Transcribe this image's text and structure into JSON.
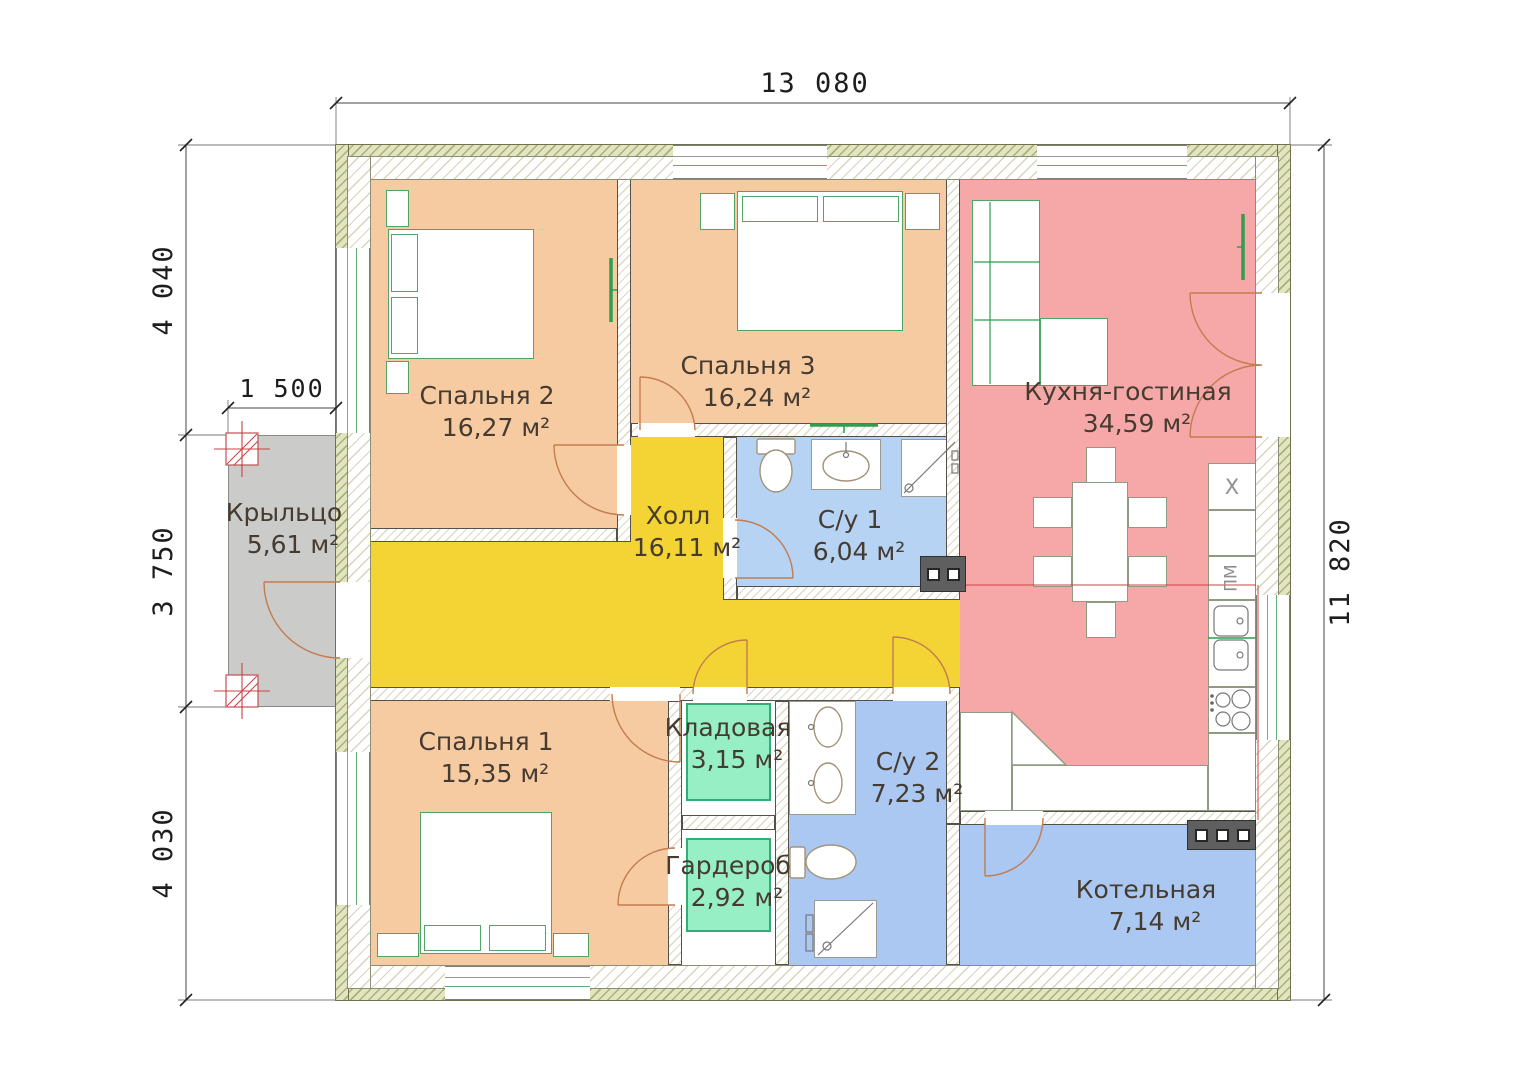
{
  "dimensions": {
    "top_width": "13 080",
    "left_upper": "4 040",
    "porch_width": "1 500",
    "left_middle": "3 750",
    "left_lower": "4 030",
    "right_height": "11 820"
  },
  "rooms": {
    "bedroom2": {
      "name": "Спальня 2",
      "area": "16,27 м²",
      "color": "#f7cba2"
    },
    "bedroom3": {
      "name": "Спальня 3",
      "area": "16,24 м²",
      "color": "#f7cba2"
    },
    "kitchen_living": {
      "name": "Кухня-гостиная",
      "area": "34,59 м²",
      "color": "#f6a8a8"
    },
    "porch": {
      "name": "Крыльцо",
      "area": "5,61 м²",
      "color": "#cbcbc9"
    },
    "hall": {
      "name": "Холл",
      "area": "16,11 м²",
      "color": "#f3d434"
    },
    "bathroom1": {
      "name": "С/у 1",
      "area": "6,04 м²",
      "color": "#b6d3f4"
    },
    "bedroom1": {
      "name": "Спальня 1",
      "area": "15,35 м²",
      "color": "#f7cba2"
    },
    "pantry": {
      "name": "Кладовая",
      "area": "3,15 м²",
      "color": "#96efc5"
    },
    "bathroom2": {
      "name": "С/у 2",
      "area": "7,23 м²",
      "color": "#aac8f1"
    },
    "wardrobe": {
      "name": "Гардероб",
      "area": "2,92 м²",
      "color": "#96efc5"
    },
    "boiler_room": {
      "name": "Котельная",
      "area": "7,14 м²",
      "color": "#aac8f1"
    }
  },
  "appliances": {
    "fridge_label": "Х",
    "dishwasher_label": "ПМ"
  }
}
